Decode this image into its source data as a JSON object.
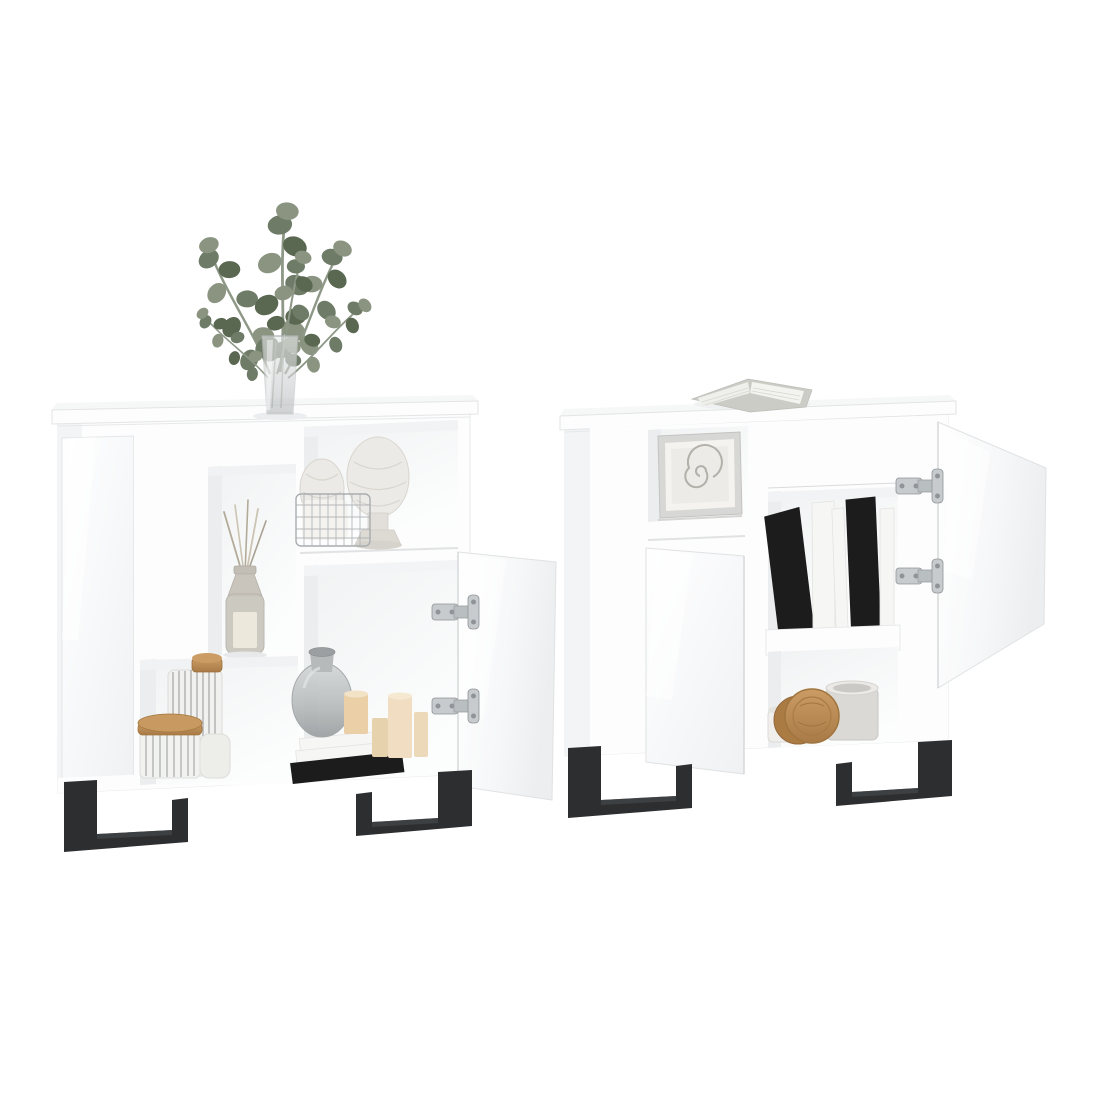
{
  "meta": {
    "kind": "product-photo",
    "subject": "Two matching white high-gloss sideboard cabinets with open doors, open shelves, decorative props and black metal sled legs on a plain white background"
  },
  "colors": {
    "background": "#ffffff",
    "panel": "#fdfdfd",
    "slabTop": "#f6f7f7",
    "panelShade": "#f3f4f5",
    "interior": "#fafbfb",
    "interiorShadow": "#ebedee",
    "edge": "#e6e8e9",
    "seam": "#d9dbdc",
    "leg": "#2c2e30",
    "legHighlight": "#4a4d4f",
    "hinge": "#c7cbcd",
    "hingeDark": "#8e9498",
    "leaf1": "#6e7b66",
    "leaf2": "#8a9480",
    "leaf3": "#5a6751",
    "stemColor": "#8e9887",
    "glass": "#cdd0d1",
    "glassDark": "#aeb2b4",
    "wood": "#bb8c54",
    "woodDark": "#9d6f3d",
    "candle": "#eacfa7",
    "candleLight": "#f0ddc2",
    "bookBlack": "#1c1c1c",
    "bookWhite": "#f6f6f5",
    "ceramic": "#eceae6",
    "ceramicShade": "#d9d5cf",
    "wire": "#a9adb0",
    "stripe": "#7e8284",
    "mug": "#dbd9d5",
    "label": "#ece8dc",
    "spiral": "#a8a49e",
    "frame": "#d7d7d5",
    "mat": "#edebe7",
    "pages": "#efefeb",
    "cover": "#ccccc6"
  },
  "scene": {
    "left_cabinet": {
      "name": "white sideboard, right door open",
      "decor": [
        "eucalyptus sprigs in a glass vase on top",
        "two artichoke finial sculptures",
        "wire basket",
        "reed diffuser bottle in niche",
        "striped storage jars with wooden lids",
        "grey glass vase on a stack of books",
        "beige pillar candles"
      ]
    },
    "right_cabinet": {
      "name": "white sideboard, left and right doors open",
      "decor": [
        "open book lying on top",
        "framed ammonite fossil print",
        "row of black and white books",
        "ceramic mug",
        "round wooden coasters",
        "small white cup"
      ]
    },
    "legs": "black metal sled legs",
    "hardware": "silver concealed euro hinges"
  }
}
